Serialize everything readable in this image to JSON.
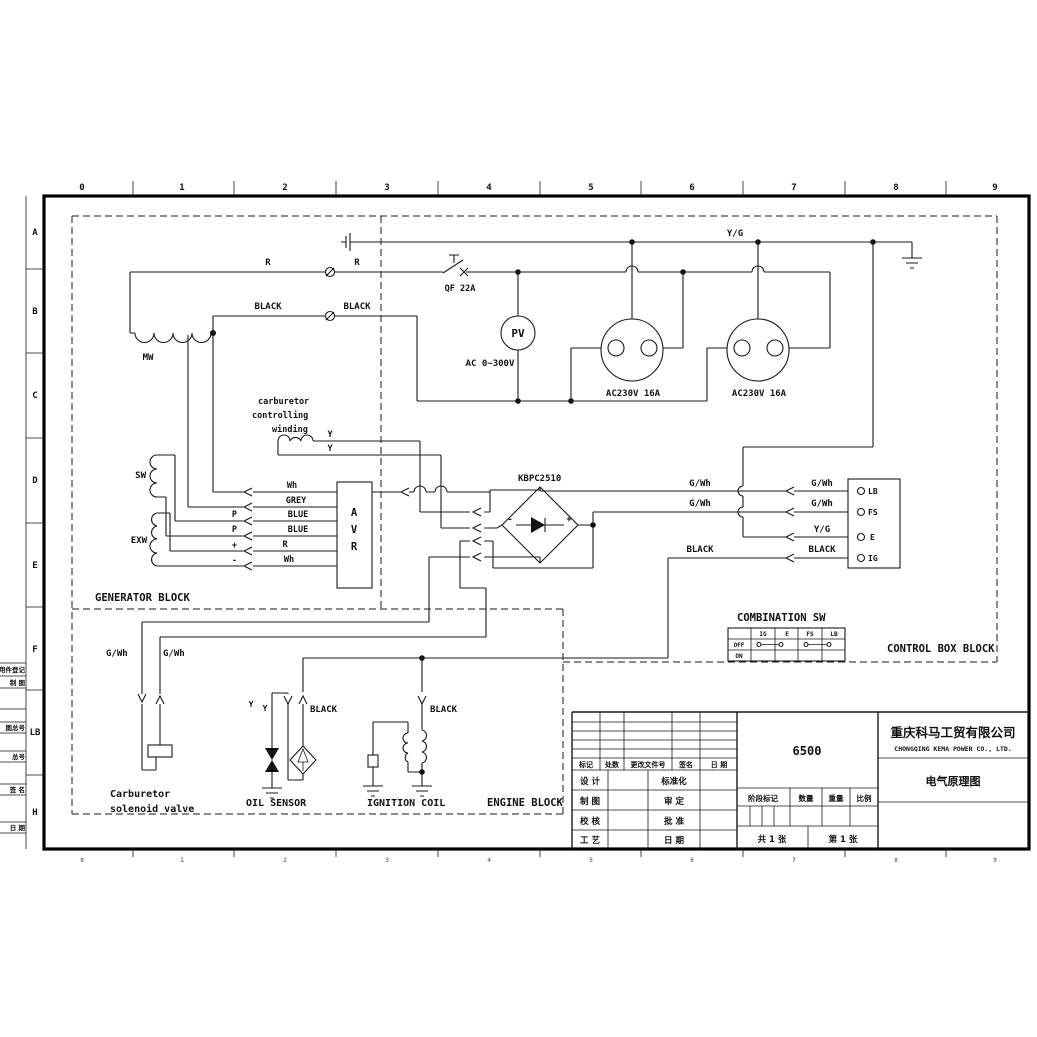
{
  "drawing": {
    "ruler_top": [
      "0",
      "1",
      "2",
      "3",
      "4",
      "5",
      "6",
      "7",
      "8",
      "9"
    ],
    "ruler_bottom": [
      "0",
      "1",
      "2",
      "3",
      "4",
      "5",
      "6",
      "7",
      "8",
      "9"
    ],
    "ruler_left": [
      "A",
      "B",
      "C",
      "D",
      "E",
      "F",
      "LB",
      "H"
    ],
    "margin_labels": [
      "用件登记",
      "制 图",
      "图总号",
      "总号",
      "签 名",
      "日 期"
    ]
  },
  "blocks": {
    "generator": "GENERATOR BLOCK",
    "control_box": "CONTROL BOX BLOCK",
    "engine": "ENGINE BLOCK"
  },
  "power": {
    "wire_r_a": "R",
    "wire_r_b": "R",
    "breaker": "QF 22A",
    "wire_black_a": "BLACK",
    "wire_black_b": "BLACK",
    "wire_yg": "Y/G",
    "meter": "PV",
    "meter_range": "AC 0~300V",
    "outlet_1": "AC230V 16A",
    "outlet_2": "AC230V 16A"
  },
  "generator": {
    "mw": "MW",
    "sw": "SW",
    "exw": "EXW",
    "avr_letters": [
      "A",
      "V",
      "R"
    ],
    "carb_line1": "carburetor",
    "carb_line2": "controlling",
    "carb_line3": "winding",
    "wire_y_a": "Y",
    "wire_y_b": "Y",
    "avr_wires": [
      "Wh",
      "GREY",
      "BLUE",
      "BLUE",
      "R",
      "Wh"
    ],
    "avr_terms": [
      "P",
      "P",
      "+",
      "-"
    ]
  },
  "rectifier": {
    "label": "KBPC2510",
    "plus": "+",
    "minus": "-"
  },
  "control": {
    "wire_gwh_a": "G/Wh",
    "wire_gwh_b": "G/Wh",
    "wire_gwh_c": "G/Wh",
    "wire_gwh_d": "G/Wh",
    "wire_yg": "Y/G",
    "wire_black_a": "BLACK",
    "wire_black_b": "BLACK",
    "terminals": [
      "LB",
      "FS",
      "E",
      "IG"
    ],
    "sw_title": "COMBINATION SW",
    "sw_cols": [
      "IG",
      "E",
      "FS",
      "LB"
    ],
    "sw_rows": [
      "OFF",
      "ON"
    ]
  },
  "engine": {
    "wire_gwh_a": "G/Wh",
    "wire_gwh_b": "G/Wh",
    "wire_y_a": "Y",
    "wire_y_b": "Y",
    "wire_black_a": "BLACK",
    "wire_black_b": "BLACK",
    "solenoid_1": "Carburetor",
    "solenoid_2": "solenoid valve",
    "oil_sensor": "OIL SENSOR",
    "ignition": "IGNITION COIL"
  },
  "title_block": {
    "model": "6500",
    "company_cn": "重庆科马工贸有限公司",
    "company_en": "CHONGQING KEMA POWER CO., LTD.",
    "drawing_title": "电气原理图",
    "rev_headers": [
      "标记",
      "处数",
      "更改文件号",
      "签名",
      "日 期"
    ],
    "col1": [
      "设 计",
      "制 图",
      "校 核",
      "工 艺"
    ],
    "col2": [
      "标准化",
      "审 定",
      "批 准",
      "日 期"
    ],
    "stage": [
      "阶段标记",
      "数量",
      "重量",
      "比例"
    ],
    "sheets_total": "共 1 张",
    "sheet_no": "第 1 张"
  }
}
